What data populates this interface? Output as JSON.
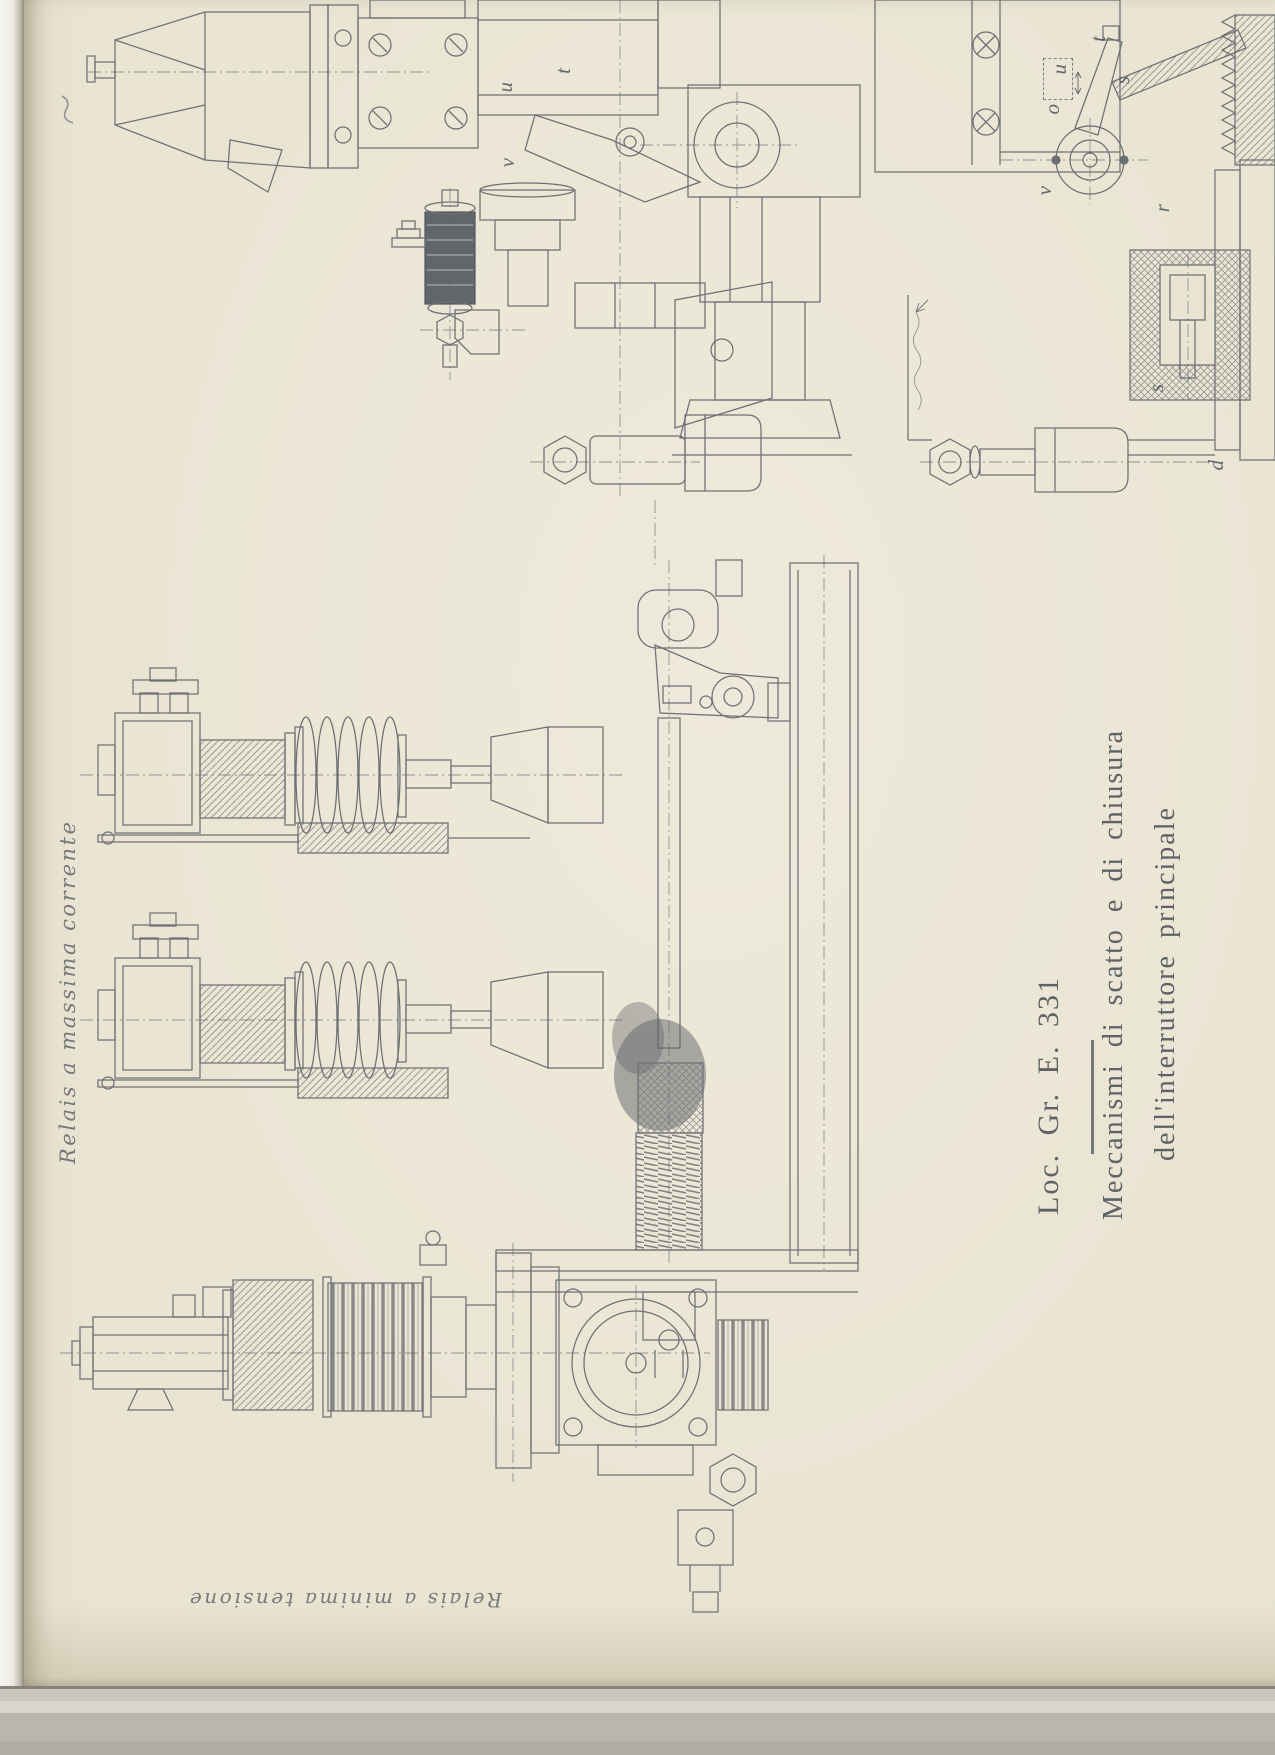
{
  "document": {
    "plate_code": "Loc. Gr. E. 331",
    "caption_line1": "Meccanismi di scatto e di chiusura",
    "caption_line2": "dell'interruttore principale"
  },
  "handwritten": {
    "left_label": "Relais a massima corrente",
    "bottom_label": "Relais a minima tensione"
  },
  "part_letters": {
    "top_left": [
      {
        "label": "u"
      },
      {
        "label": "t"
      },
      {
        "label": "v"
      }
    ],
    "top_right": [
      {
        "label": "t"
      },
      {
        "label": "u"
      },
      {
        "label": "s"
      },
      {
        "label": "o"
      },
      {
        "label": "v"
      },
      {
        "label": "r"
      },
      {
        "label": "s"
      },
      {
        "label": "d"
      }
    ]
  },
  "colors": {
    "paper": "#eae5d3",
    "line_ink": "#575b64",
    "title_ink": "#4b5058",
    "footer_strip": "#b7b3ab"
  }
}
